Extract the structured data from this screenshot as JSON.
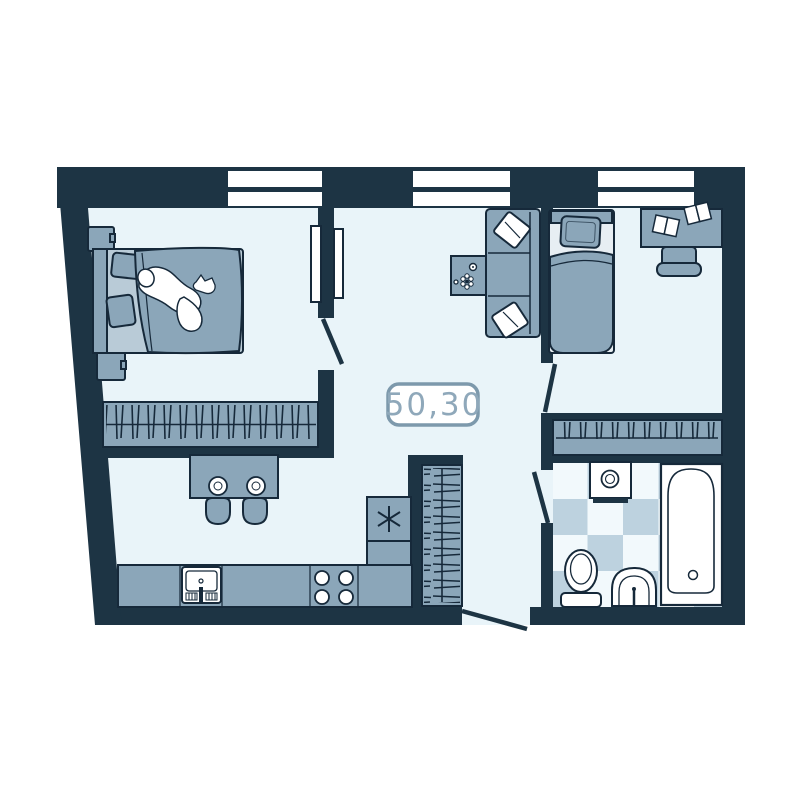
{
  "plan": {
    "area_label": "50,30",
    "windows_count": 3,
    "door_swings_count": 4,
    "rooms": [
      {
        "id": "bedroom-1",
        "furniture": [
          "double-bed",
          "sleeping-person",
          "nightstand",
          "nightstand",
          "wardrobe-with-hangers"
        ]
      },
      {
        "id": "living-room",
        "furniture": [
          "sofa",
          "sofa-pillows",
          "coffee-table",
          "sliding-door"
        ]
      },
      {
        "id": "bedroom-2",
        "furniture": [
          "single-bed",
          "pillow",
          "desk",
          "open-books",
          "chair",
          "wardrobe-with-hangers"
        ]
      },
      {
        "id": "kitchen",
        "furniture": [
          "bar-table",
          "plates",
          "bar-stools",
          "counter",
          "kitchen-sink",
          "stove",
          "refrigerator"
        ]
      },
      {
        "id": "hallway",
        "furniture": [
          "closet-with-hangers",
          "entrance-door"
        ]
      },
      {
        "id": "bathroom",
        "furniture": [
          "washing-machine",
          "toilet",
          "wash-basin",
          "bathtub",
          "checkered-tile-floor"
        ]
      }
    ]
  },
  "colors": {
    "wall": "#1d3444",
    "floor": "#e9f4f9",
    "furniture": "#8ba6b9",
    "furniture_light": "#b9cbd7",
    "bed_sheet": "#e7eef3",
    "outline": "#16293a",
    "white": "#ffffff",
    "tile_blue": "#bdd2df",
    "tile_white": "#f2f9fc",
    "label_border": "#7d99ac",
    "label_text": "#8fa8ba"
  }
}
